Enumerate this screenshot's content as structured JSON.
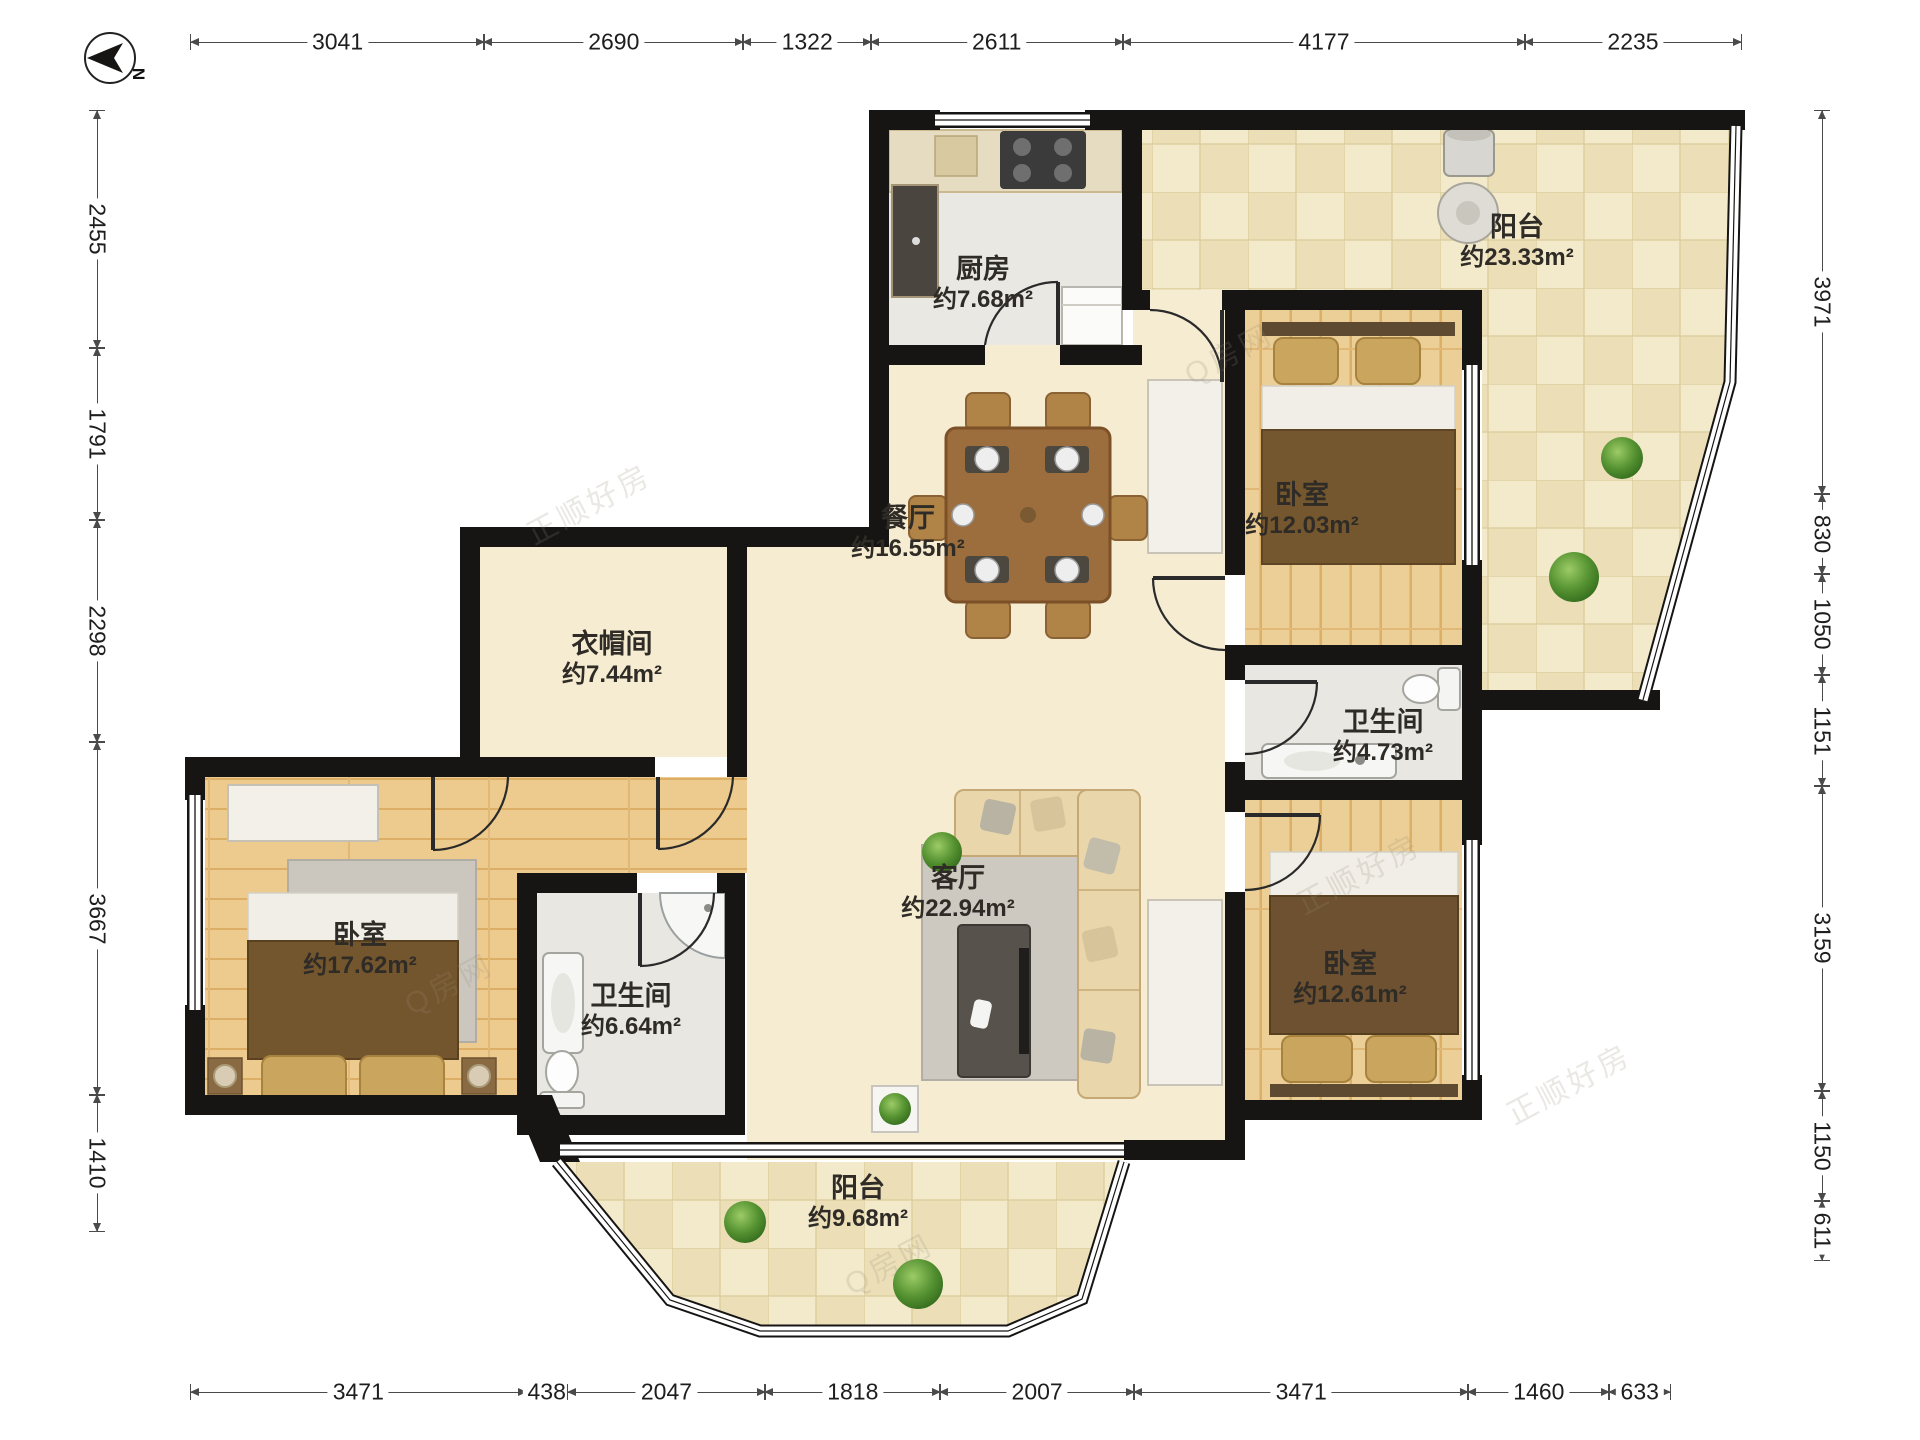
{
  "compass": {
    "label": "N"
  },
  "watermarks": [
    "正顺好房",
    "Q房网"
  ],
  "dimensions": {
    "top": [
      3041,
      2690,
      1322,
      2611,
      4177,
      2235
    ],
    "left": [
      2455,
      1791,
      2298,
      3667,
      1410
    ],
    "right": [
      3971,
      830,
      1050,
      1151,
      3159,
      1150,
      611
    ],
    "bottom": [
      3471,
      438,
      2047,
      1818,
      2007,
      3471,
      1460,
      633
    ]
  },
  "rooms": [
    {
      "id": "kitchen",
      "name": "厨房",
      "area": "约7.68m²"
    },
    {
      "id": "balcony-north",
      "name": "阳台",
      "area": "约23.33m²"
    },
    {
      "id": "bedroom-ne",
      "name": "卧室",
      "area": "约12.03m²"
    },
    {
      "id": "dining",
      "name": "餐厅",
      "area": "约16.55m²"
    },
    {
      "id": "cloakroom",
      "name": "衣帽间",
      "area": "约7.44m²"
    },
    {
      "id": "bathroom-east",
      "name": "卫生间",
      "area": "约4.73m²"
    },
    {
      "id": "bedroom-west",
      "name": "卧室",
      "area": "约17.62m²"
    },
    {
      "id": "bathroom-west",
      "name": "卫生间",
      "area": "约6.64m²"
    },
    {
      "id": "living",
      "name": "客厅",
      "area": "约22.94m²"
    },
    {
      "id": "bedroom-se",
      "name": "卧室",
      "area": "约12.61m²"
    },
    {
      "id": "balcony-south",
      "name": "阳台",
      "area": "约9.68m²"
    }
  ],
  "colors": {
    "wall": "#161514",
    "wood_floor": "#edcb8f",
    "marble_floor": "#f6ecd2",
    "tile_floor": "#f3e9cb",
    "gray_floor": "#e9e7e2",
    "bed_blanket": "#75572f",
    "dim_text": "#1e1e1e"
  }
}
